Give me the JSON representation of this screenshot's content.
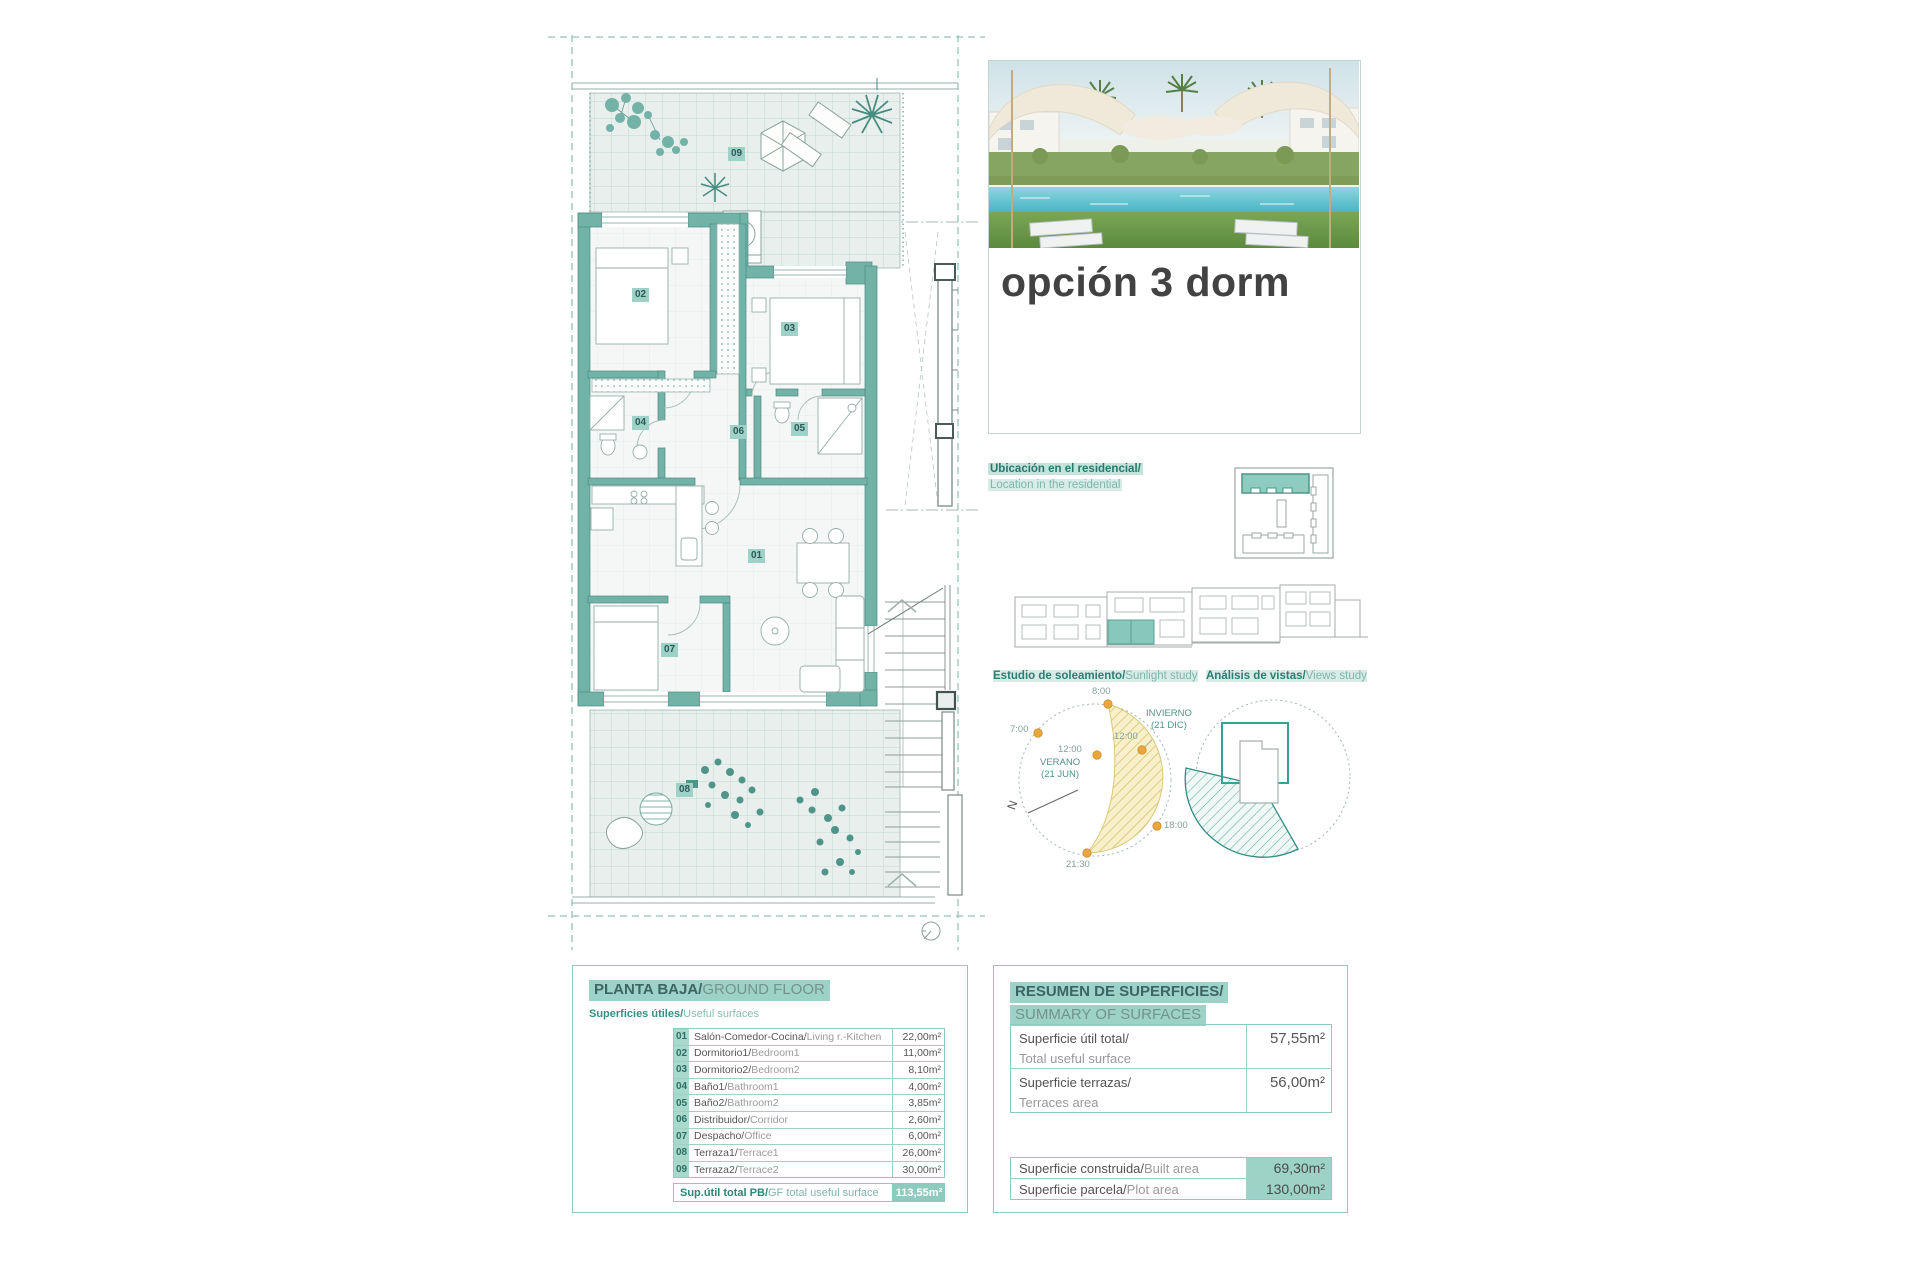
{
  "hero": {
    "title": "opción 3 dorm"
  },
  "location": {
    "es": "Ubicación en el residencial/",
    "en": "Location in the residential"
  },
  "studies": {
    "sunlight": {
      "es": "Estudio de soleamiento/",
      "en": "Sunlight study",
      "labels": {
        "h8": "8:00",
        "h7": "7:00",
        "h12w": "12:00",
        "h12s": "12:00",
        "h18": "18:00",
        "h2130": "21:30",
        "winter1": "INVIERNO",
        "winter2": "(21 DIC)",
        "summer1": "VERANO",
        "summer2": "(21 JUN)",
        "north": "N"
      }
    },
    "views": {
      "es": "Análisis de vistas/",
      "en": "Views study"
    }
  },
  "plan": {
    "rooms": [
      {
        "num": "01"
      },
      {
        "num": "02"
      },
      {
        "num": "03"
      },
      {
        "num": "04"
      },
      {
        "num": "05"
      },
      {
        "num": "06"
      },
      {
        "num": "07"
      },
      {
        "num": "08"
      },
      {
        "num": "09"
      }
    ]
  },
  "gf": {
    "title_es": "PLANTA BAJA/",
    "title_en": "GROUND FLOOR",
    "subtitle_es": "Superficies útiles/",
    "subtitle_en": "Useful surfaces",
    "rows": [
      {
        "num": "01",
        "es": "Salón-Comedor-Cocina/",
        "en": "Living r.-Kitchen",
        "value": "22,00m²"
      },
      {
        "num": "02",
        "es": "Dormitorio1/",
        "en": "Bedroom1",
        "value": "11,00m²"
      },
      {
        "num": "03",
        "es": "Dormitorio2/",
        "en": "Bedroom2",
        "value": "8,10m²"
      },
      {
        "num": "04",
        "es": "Baño1/",
        "en": "Bathroom1",
        "value": "4,00m²"
      },
      {
        "num": "05",
        "es": "Baño2/",
        "en": "Bathroom2",
        "value": "3,85m²"
      },
      {
        "num": "06",
        "es": "Distribuidor/",
        "en": "Corridor",
        "value": "2,60m²"
      },
      {
        "num": "07",
        "es": "Despacho/",
        "en": "Office",
        "value": "6,00m²"
      },
      {
        "num": "08",
        "es": "Terraza1/",
        "en": "Terrace1",
        "value": "26,00m²"
      },
      {
        "num": "09",
        "es": "Terraza2/",
        "en": "Terrace2",
        "value": "30,00m²"
      }
    ],
    "total_es": "Sup.útil total PB/",
    "total_en": "GF total useful surface",
    "total_value": "113,55m²"
  },
  "summary": {
    "title_es": "RESUMEN DE SUPERFICIES/",
    "title_en": "SUMMARY OF SURFACES",
    "rows_top": [
      {
        "es": "Superficie útil total/",
        "en": "Total useful surface",
        "value": "57,55m²"
      },
      {
        "es": "Superficie terrazas/",
        "en": "Terraces area",
        "value": "56,00m²"
      }
    ],
    "rows_bottom": [
      {
        "es": "Superficie construida/",
        "en": "Built area",
        "value": "69,30m²"
      },
      {
        "es": "Superficie parcela/",
        "en": "Plot area",
        "value": "130,00m²"
      }
    ]
  },
  "colors": {
    "accent_wall": "#72b3a8",
    "highlight": "#9dd3c6",
    "table_border": "#8fcabe",
    "sun_yellow": "#f8f0cb",
    "sun_orange": "#eaa53c",
    "views_teal": "#2f8d81"
  }
}
